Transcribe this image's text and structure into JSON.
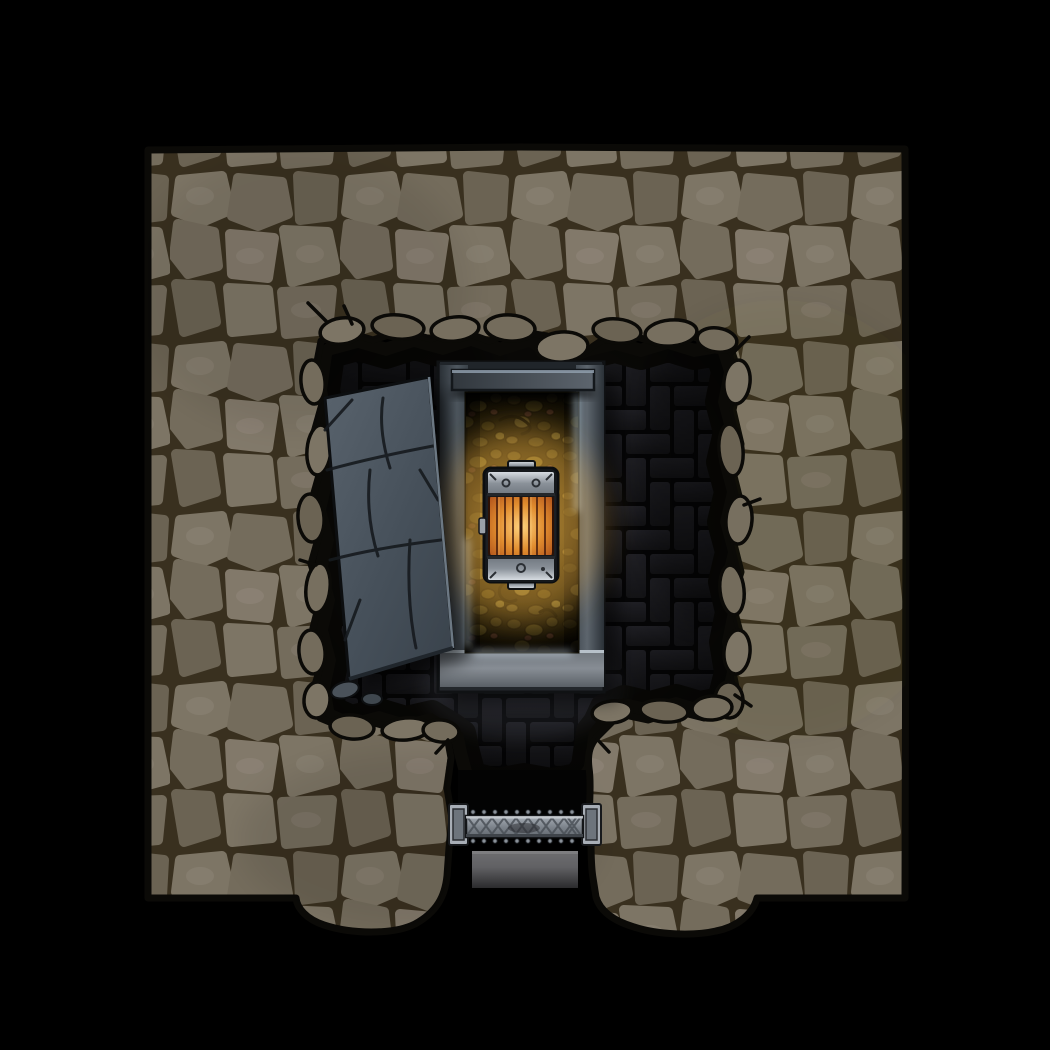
{
  "page": {
    "title": "Crypt chamber dungeon battle map",
    "background": "#000000"
  },
  "scene": {
    "type": "top-down dungeon battle map",
    "description": "Square rough-stone wall block surrounding a dark crypt room with herringbone brick floor; an open stone sarcophagus with golden treasure interior and a banded wooden chest; a cracked slab lid leaning displaced to the left; a metal barred door in the south wall opening to a short dark corridor."
  },
  "objects": {
    "wall": {
      "label": "rough cobblestone wall"
    },
    "floor": {
      "label": "herringbone brick crypt floor"
    },
    "slab": {
      "label": "displaced cracked sarcophagus lid slab"
    },
    "sarcophagus": {
      "label": "open stone sarcophagus"
    },
    "pit": {
      "label": "sarcophagus interior filled with golden treasure"
    },
    "chest": {
      "label": "metal-banded wooden chest"
    },
    "door": {
      "label": "barred metal door, south exit"
    },
    "corridor": {
      "label": "dark south corridor"
    }
  },
  "palette": {
    "ink": "#0b0a07",
    "mortar": "#39301f",
    "wall1": "#7d7565",
    "wall2": "#746c5c",
    "wall3": "#6b6353",
    "wall4": "#82796a",
    "rimstone": "#776f5f",
    "brick": "#24242a",
    "brickDark": "#161619",
    "slab1": "#59636d",
    "slab2": "#39424b",
    "slabCrack": "#161a1e",
    "frame1": "#4e575f",
    "frame2": "#2b3137",
    "frameLight": "#c8d7e4",
    "frameBottom": "#878d94",
    "goldBase": "#2a2108",
    "gold1": "#6b5b22",
    "gold2": "#52451a",
    "goldRed": "#6f4130",
    "goldGlow": "#ffcf6e",
    "wood1": "#ffd27e",
    "wood2": "#e08c2e",
    "wood3": "#8d3f16",
    "woodSeam": "#3a1206",
    "metal1": "#dde2e7",
    "metal2": "#8a9199",
    "metalDark": "#2b2f34",
    "door1": "#a8aeb6",
    "door2": "#7b828a",
    "doorHatch": "#4b5158",
    "corridorFloor": "#616164"
  }
}
